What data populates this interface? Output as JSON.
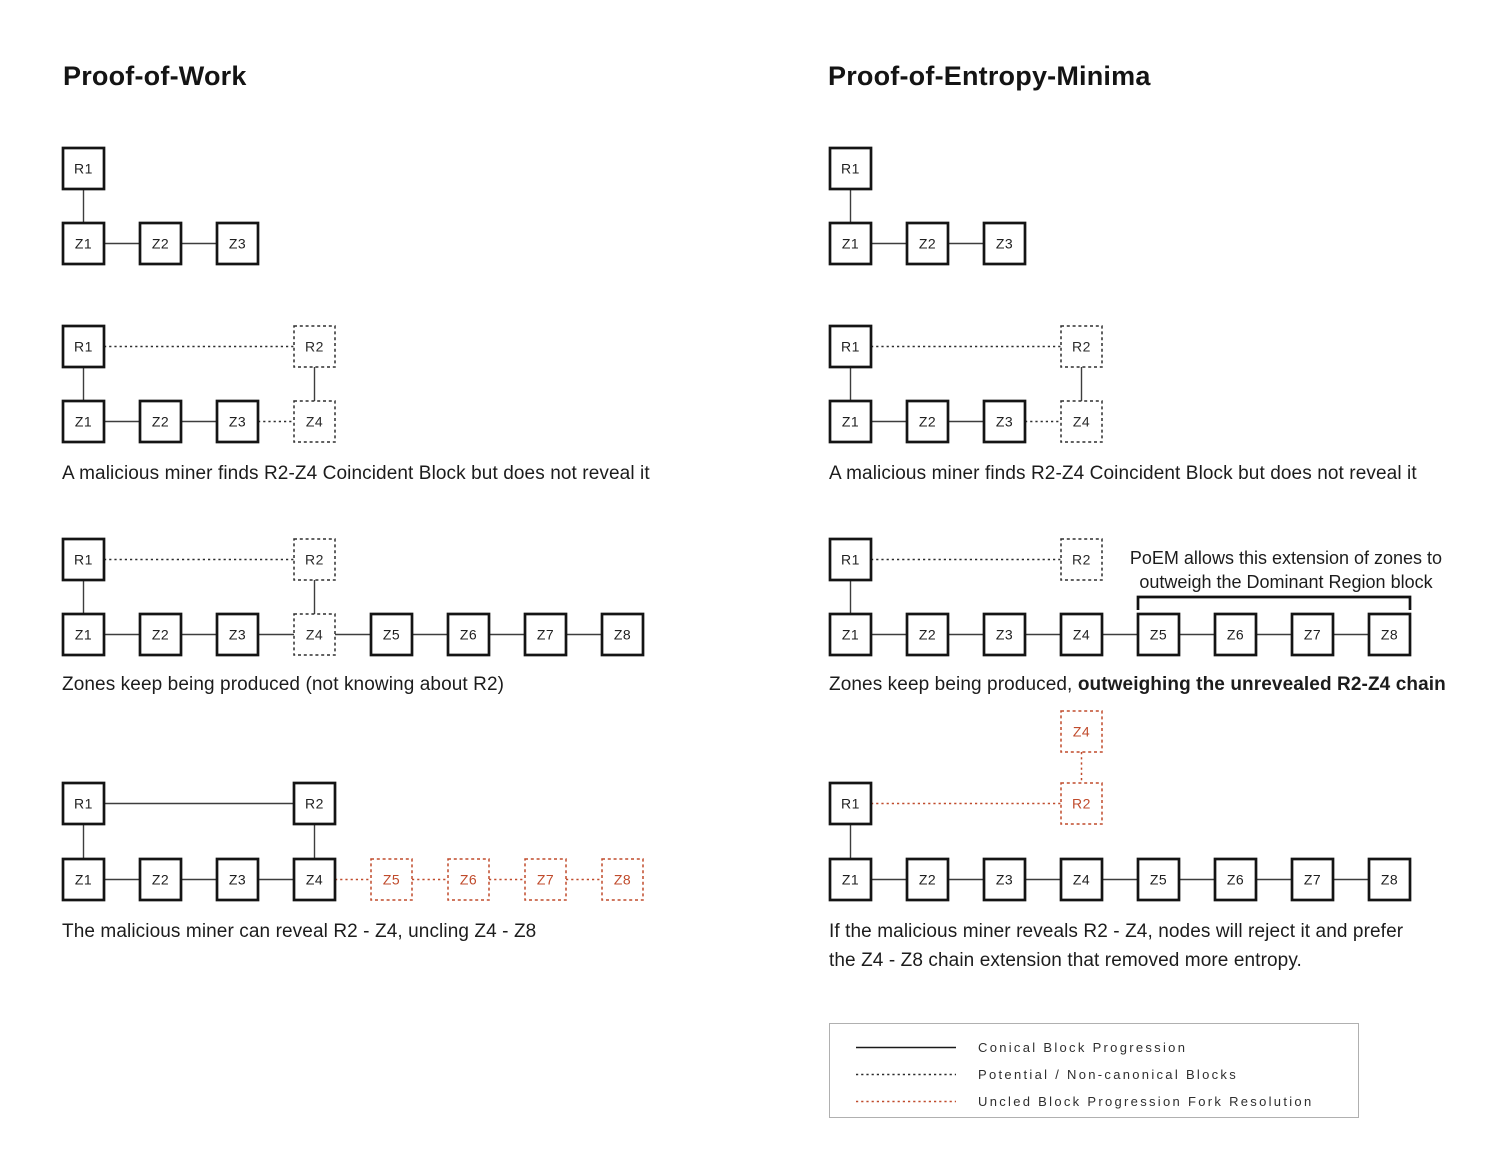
{
  "titles": {
    "left": "Proof-of-Work",
    "right": "Proof-of-Entropy-Minima"
  },
  "captions": {
    "pow_find": "A malicious miner finds R2-Z4 Coincident Block but does not reveal it",
    "pow_zones": "Zones keep being produced (not knowing about R2)",
    "pow_reveal": "The malicious miner can reveal R2 - Z4, uncling Z4 - Z8",
    "poem_find": "A malicious miner finds R2-Z4 Coincident Block but does not reveal it",
    "poem_zones_normal": "Zones keep being produced, ",
    "poem_zones_bold": "outweighing the unrevealed R2-Z4 chain",
    "poem_reveal": "If the malicious miner reveals R2 - Z4, nodes will reject it and prefer\nthe Z4 - Z8 chain extension that removed more entropy."
  },
  "annotation": "PoEM allows this extension of zones to\noutweigh the Dominant Region block",
  "legend": {
    "items": [
      {
        "line_style": "solid",
        "color": "#1a1a1a",
        "label": "Conical Block Progression"
      },
      {
        "line_style": "dashed",
        "color": "#2b2b2b",
        "label": "Potential / Non-canonical Blocks"
      },
      {
        "line_style": "dashed",
        "color": "#c04b2c",
        "label": "Uncled Block Progression Fork Resolution"
      }
    ]
  },
  "colors": {
    "ink": "#141414",
    "solid_line": "#3d3d3d",
    "dash_line": "#2e2e2e",
    "red": "#c04b2c",
    "label": "#1f1f1f"
  },
  "geometry": {
    "box": 41,
    "pitch": 77
  },
  "diagrams": [
    {
      "name": "pow-genesis",
      "x0": 63,
      "nodes": [
        {
          "id": "R1",
          "label": "R1",
          "col": 0,
          "y": 148,
          "style": "solid"
        },
        {
          "id": "Z1",
          "label": "Z1",
          "col": 0,
          "y": 223,
          "style": "solid"
        },
        {
          "id": "Z2",
          "label": "Z2",
          "col": 1,
          "y": 223,
          "style": "solid"
        },
        {
          "id": "Z3",
          "label": "Z3",
          "col": 2,
          "y": 223,
          "style": "solid"
        }
      ],
      "edges": [
        {
          "from": "R1",
          "to": "Z1",
          "style": "solid"
        },
        {
          "from": "Z1",
          "to": "Z2",
          "style": "solid"
        },
        {
          "from": "Z2",
          "to": "Z3",
          "style": "solid"
        }
      ]
    },
    {
      "name": "pow-hidden-coincident",
      "x0": 63,
      "nodes": [
        {
          "id": "R1",
          "label": "R1",
          "col": 0,
          "y": 326,
          "style": "solid"
        },
        {
          "id": "R2",
          "label": "R2",
          "col": 3,
          "y": 326,
          "style": "dash"
        },
        {
          "id": "Z1",
          "label": "Z1",
          "col": 0,
          "y": 401,
          "style": "solid"
        },
        {
          "id": "Z2",
          "label": "Z2",
          "col": 1,
          "y": 401,
          "style": "solid"
        },
        {
          "id": "Z3",
          "label": "Z3",
          "col": 2,
          "y": 401,
          "style": "solid"
        },
        {
          "id": "Z4",
          "label": "Z4",
          "col": 3,
          "y": 401,
          "style": "dash"
        }
      ],
      "edges": [
        {
          "from": "R1",
          "to": "R2",
          "style": "dash"
        },
        {
          "from": "R1",
          "to": "Z1",
          "style": "solid"
        },
        {
          "from": "R2",
          "to": "Z4",
          "style": "solid"
        },
        {
          "from": "Z1",
          "to": "Z2",
          "style": "solid"
        },
        {
          "from": "Z2",
          "to": "Z3",
          "style": "solid"
        },
        {
          "from": "Z3",
          "to": "Z4",
          "style": "dash"
        }
      ]
    },
    {
      "name": "pow-zones-produced",
      "x0": 63,
      "nodes": [
        {
          "id": "R1",
          "label": "R1",
          "col": 0,
          "y": 539,
          "style": "solid"
        },
        {
          "id": "R2",
          "label": "R2",
          "col": 3,
          "y": 539,
          "style": "dash"
        },
        {
          "id": "Z1",
          "label": "Z1",
          "col": 0,
          "y": 614,
          "style": "solid"
        },
        {
          "id": "Z2",
          "label": "Z2",
          "col": 1,
          "y": 614,
          "style": "solid"
        },
        {
          "id": "Z3",
          "label": "Z3",
          "col": 2,
          "y": 614,
          "style": "solid"
        },
        {
          "id": "Z4",
          "label": "Z4",
          "col": 3,
          "y": 614,
          "style": "dash"
        },
        {
          "id": "Z5",
          "label": "Z5",
          "col": 4,
          "y": 614,
          "style": "solid"
        },
        {
          "id": "Z6",
          "label": "Z6",
          "col": 5,
          "y": 614,
          "style": "solid"
        },
        {
          "id": "Z7",
          "label": "Z7",
          "col": 6,
          "y": 614,
          "style": "solid"
        },
        {
          "id": "Z8",
          "label": "Z8",
          "col": 7,
          "y": 614,
          "style": "solid"
        }
      ],
      "edges": [
        {
          "from": "R1",
          "to": "R2",
          "style": "dash"
        },
        {
          "from": "R1",
          "to": "Z1",
          "style": "solid"
        },
        {
          "from": "R2",
          "to": "Z4",
          "style": "solid"
        },
        {
          "from": "Z1",
          "to": "Z2",
          "style": "solid"
        },
        {
          "from": "Z2",
          "to": "Z3",
          "style": "solid"
        },
        {
          "from": "Z3",
          "to": "Z4",
          "style": "solid"
        },
        {
          "from": "Z4",
          "to": "Z5",
          "style": "solid"
        },
        {
          "from": "Z5",
          "to": "Z6",
          "style": "solid"
        },
        {
          "from": "Z6",
          "to": "Z7",
          "style": "solid"
        },
        {
          "from": "Z7",
          "to": "Z8",
          "style": "solid"
        }
      ]
    },
    {
      "name": "pow-reveal-uncle",
      "x0": 63,
      "nodes": [
        {
          "id": "R1",
          "label": "R1",
          "col": 0,
          "y": 783,
          "style": "solid"
        },
        {
          "id": "R2",
          "label": "R2",
          "col": 3,
          "y": 783,
          "style": "solid"
        },
        {
          "id": "Z1",
          "label": "Z1",
          "col": 0,
          "y": 859,
          "style": "solid"
        },
        {
          "id": "Z2",
          "label": "Z2",
          "col": 1,
          "y": 859,
          "style": "solid"
        },
        {
          "id": "Z3",
          "label": "Z3",
          "col": 2,
          "y": 859,
          "style": "solid"
        },
        {
          "id": "Z4",
          "label": "Z4",
          "col": 3,
          "y": 859,
          "style": "solid"
        },
        {
          "id": "Z5",
          "label": "Z5",
          "col": 4,
          "y": 859,
          "style": "reddash"
        },
        {
          "id": "Z6",
          "label": "Z6",
          "col": 5,
          "y": 859,
          "style": "reddash"
        },
        {
          "id": "Z7",
          "label": "Z7",
          "col": 6,
          "y": 859,
          "style": "reddash"
        },
        {
          "id": "Z8",
          "label": "Z8",
          "col": 7,
          "y": 859,
          "style": "reddash"
        }
      ],
      "edges": [
        {
          "from": "R1",
          "to": "R2",
          "style": "solid"
        },
        {
          "from": "R1",
          "to": "Z1",
          "style": "solid"
        },
        {
          "from": "R2",
          "to": "Z4",
          "style": "solid"
        },
        {
          "from": "Z1",
          "to": "Z2",
          "style": "solid"
        },
        {
          "from": "Z2",
          "to": "Z3",
          "style": "solid"
        },
        {
          "from": "Z3",
          "to": "Z4",
          "style": "solid"
        },
        {
          "from": "Z4",
          "to": "Z5",
          "style": "reddash"
        },
        {
          "from": "Z5",
          "to": "Z6",
          "style": "reddash"
        },
        {
          "from": "Z6",
          "to": "Z7",
          "style": "reddash"
        },
        {
          "from": "Z7",
          "to": "Z8",
          "style": "reddash"
        }
      ]
    },
    {
      "name": "poem-genesis",
      "x0": 830,
      "nodes": [
        {
          "id": "R1",
          "label": "R1",
          "col": 0,
          "y": 148,
          "style": "solid"
        },
        {
          "id": "Z1",
          "label": "Z1",
          "col": 0,
          "y": 223,
          "style": "solid"
        },
        {
          "id": "Z2",
          "label": "Z2",
          "col": 1,
          "y": 223,
          "style": "solid"
        },
        {
          "id": "Z3",
          "label": "Z3",
          "col": 2,
          "y": 223,
          "style": "solid"
        }
      ],
      "edges": [
        {
          "from": "R1",
          "to": "Z1",
          "style": "solid"
        },
        {
          "from": "Z1",
          "to": "Z2",
          "style": "solid"
        },
        {
          "from": "Z2",
          "to": "Z3",
          "style": "solid"
        }
      ]
    },
    {
      "name": "poem-hidden-coincident",
      "x0": 830,
      "nodes": [
        {
          "id": "R1",
          "label": "R1",
          "col": 0,
          "y": 326,
          "style": "solid"
        },
        {
          "id": "R2",
          "label": "R2",
          "col": 3,
          "y": 326,
          "style": "dash"
        },
        {
          "id": "Z1",
          "label": "Z1",
          "col": 0,
          "y": 401,
          "style": "solid"
        },
        {
          "id": "Z2",
          "label": "Z2",
          "col": 1,
          "y": 401,
          "style": "solid"
        },
        {
          "id": "Z3",
          "label": "Z3",
          "col": 2,
          "y": 401,
          "style": "solid"
        },
        {
          "id": "Z4",
          "label": "Z4",
          "col": 3,
          "y": 401,
          "style": "dash"
        }
      ],
      "edges": [
        {
          "from": "R1",
          "to": "R2",
          "style": "dash"
        },
        {
          "from": "R1",
          "to": "Z1",
          "style": "solid"
        },
        {
          "from": "R2",
          "to": "Z4",
          "style": "solid"
        },
        {
          "from": "Z1",
          "to": "Z2",
          "style": "solid"
        },
        {
          "from": "Z2",
          "to": "Z3",
          "style": "solid"
        },
        {
          "from": "Z3",
          "to": "Z4",
          "style": "dash"
        }
      ]
    },
    {
      "name": "poem-zones-outweigh",
      "x0": 830,
      "nodes": [
        {
          "id": "R1",
          "label": "R1",
          "col": 0,
          "y": 539,
          "style": "solid"
        },
        {
          "id": "R2",
          "label": "R2",
          "col": 3,
          "y": 539,
          "style": "dash"
        },
        {
          "id": "Z1",
          "label": "Z1",
          "col": 0,
          "y": 614,
          "style": "solid"
        },
        {
          "id": "Z2",
          "label": "Z2",
          "col": 1,
          "y": 614,
          "style": "solid"
        },
        {
          "id": "Z3",
          "label": "Z3",
          "col": 2,
          "y": 614,
          "style": "solid"
        },
        {
          "id": "Z4",
          "label": "Z4",
          "col": 3,
          "y": 614,
          "style": "solid"
        },
        {
          "id": "Z5",
          "label": "Z5",
          "col": 4,
          "y": 614,
          "style": "solid"
        },
        {
          "id": "Z6",
          "label": "Z6",
          "col": 5,
          "y": 614,
          "style": "solid"
        },
        {
          "id": "Z7",
          "label": "Z7",
          "col": 6,
          "y": 614,
          "style": "solid"
        },
        {
          "id": "Z8",
          "label": "Z8",
          "col": 7,
          "y": 614,
          "style": "solid"
        }
      ],
      "edges": [
        {
          "from": "R1",
          "to": "R2",
          "style": "dash"
        },
        {
          "from": "R1",
          "to": "Z1",
          "style": "solid"
        },
        {
          "from": "Z1",
          "to": "Z2",
          "style": "solid"
        },
        {
          "from": "Z2",
          "to": "Z3",
          "style": "solid"
        },
        {
          "from": "Z3",
          "to": "Z4",
          "style": "solid"
        },
        {
          "from": "Z4",
          "to": "Z5",
          "style": "solid"
        },
        {
          "from": "Z5",
          "to": "Z6",
          "style": "solid"
        },
        {
          "from": "Z6",
          "to": "Z7",
          "style": "solid"
        },
        {
          "from": "Z7",
          "to": "Z8",
          "style": "solid"
        }
      ],
      "bracket": {
        "from_col": 4,
        "to_col": 7,
        "y": 597,
        "tick": 13
      }
    },
    {
      "name": "poem-reject-reveal",
      "x0": 830,
      "nodes": [
        {
          "id": "Z4u",
          "label": "Z4",
          "col": 3,
          "y": 711,
          "style": "reddash"
        },
        {
          "id": "R2",
          "label": "R2",
          "col": 3,
          "y": 783,
          "style": "reddash"
        },
        {
          "id": "R1",
          "label": "R1",
          "col": 0,
          "y": 783,
          "style": "solid"
        },
        {
          "id": "Z1",
          "label": "Z1",
          "col": 0,
          "y": 859,
          "style": "solid"
        },
        {
          "id": "Z2",
          "label": "Z2",
          "col": 1,
          "y": 859,
          "style": "solid"
        },
        {
          "id": "Z3",
          "label": "Z3",
          "col": 2,
          "y": 859,
          "style": "solid"
        },
        {
          "id": "Z4",
          "label": "Z4",
          "col": 3,
          "y": 859,
          "style": "solid"
        },
        {
          "id": "Z5",
          "label": "Z5",
          "col": 4,
          "y": 859,
          "style": "solid"
        },
        {
          "id": "Z6",
          "label": "Z6",
          "col": 5,
          "y": 859,
          "style": "solid"
        },
        {
          "id": "Z7",
          "label": "Z7",
          "col": 6,
          "y": 859,
          "style": "solid"
        },
        {
          "id": "Z8",
          "label": "Z8",
          "col": 7,
          "y": 859,
          "style": "solid"
        }
      ],
      "edges": [
        {
          "from": "Z4u",
          "to": "R2",
          "style": "reddash"
        },
        {
          "from": "R1",
          "to": "R2",
          "style": "reddash"
        },
        {
          "from": "R1",
          "to": "Z1",
          "style": "solid"
        },
        {
          "from": "Z1",
          "to": "Z2",
          "style": "solid"
        },
        {
          "from": "Z2",
          "to": "Z3",
          "style": "solid"
        },
        {
          "from": "Z3",
          "to": "Z4",
          "style": "solid"
        },
        {
          "from": "Z4",
          "to": "Z5",
          "style": "solid"
        },
        {
          "from": "Z5",
          "to": "Z6",
          "style": "solid"
        },
        {
          "from": "Z6",
          "to": "Z7",
          "style": "solid"
        },
        {
          "from": "Z7",
          "to": "Z8",
          "style": "solid"
        }
      ]
    }
  ]
}
